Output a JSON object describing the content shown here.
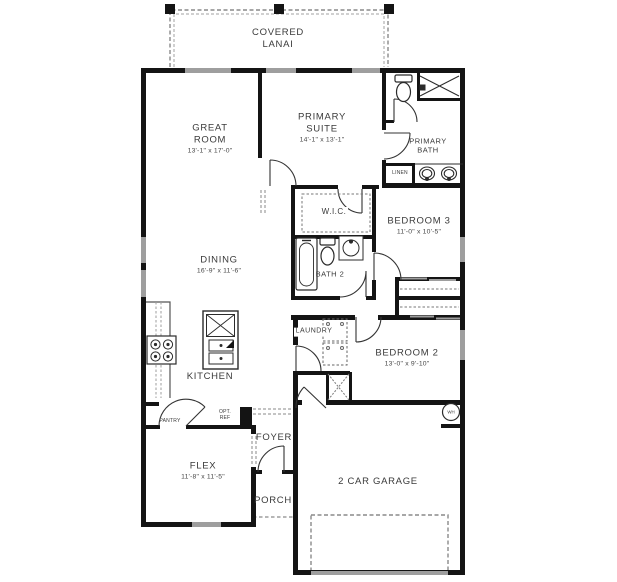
{
  "plan": {
    "covered_lanai": {
      "name": "COVERED LANAI"
    },
    "great_room": {
      "name": "GREAT ROOM",
      "dims": "13'-1\" x 17'-0\""
    },
    "primary_suite": {
      "name": "PRIMARY SUITE",
      "dims": "14'-1\" x 13'-1\""
    },
    "primary_bath": {
      "name": "PRIMARY BATH"
    },
    "linen": {
      "name": "LINEN"
    },
    "bedroom_3": {
      "name": "BEDROOM 3",
      "dims": "11'-0\" x 10'-5\""
    },
    "wic": {
      "name": "W.I.C."
    },
    "bath_2": {
      "name": "BATH 2"
    },
    "dining": {
      "name": "DINING",
      "dims": "16'-9\" x 11'-6\""
    },
    "kitchen": {
      "name": "KITCHEN"
    },
    "laundry": {
      "name": "LAUNDRY"
    },
    "bedroom_2": {
      "name": "BEDROOM 2",
      "dims": "13'-0\" x 9'-10\""
    },
    "pantry": {
      "name": "PANTRY"
    },
    "opt_ref": {
      "name": "OPT. REF"
    },
    "foyer": {
      "name": "FOYER"
    },
    "flex": {
      "name": "FLEX",
      "dims": "11'-8\" x 11'-5\""
    },
    "porch": {
      "name": "PORCH"
    },
    "garage": {
      "name": "2 CAR GARAGE"
    },
    "water_heater": {
      "name": "WH"
    }
  },
  "colors": {
    "wall": "#141414",
    "window": "#9e9e9e",
    "line": "#2b2b2b",
    "dashed": "#8a8a8a",
    "text": "#3a3a3a",
    "background": "#ffffff"
  }
}
